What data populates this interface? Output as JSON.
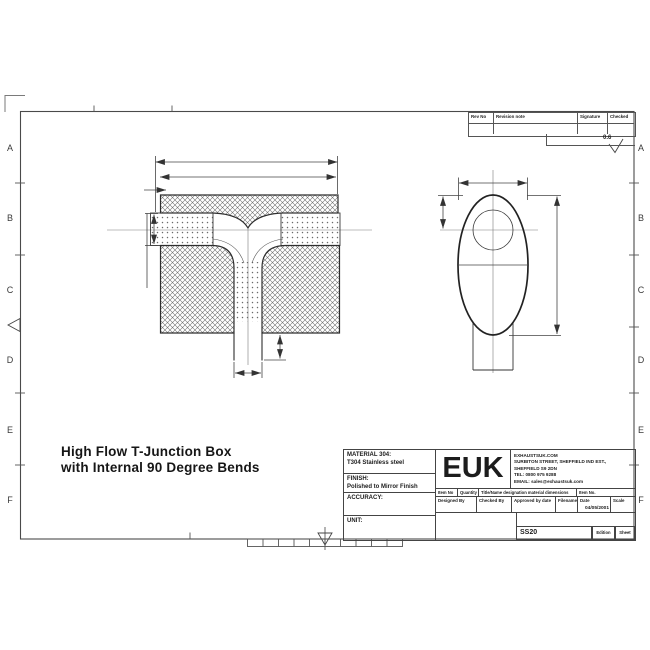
{
  "sheet": {
    "title_line1": "High Flow T-Junction Box",
    "title_line2": "with Internal 90 Degree Bends",
    "zone_letters": [
      "A",
      "B",
      "C",
      "D",
      "E",
      "F"
    ],
    "surface_finish_value": "0.6"
  },
  "revision_table": {
    "headers": [
      "Rev No",
      "Revision note",
      "Signature",
      "Checked"
    ]
  },
  "title_block": {
    "material_label": "MATERIAL 304:",
    "material_value": "T304 Stainless steel",
    "finish_label": "FINISH:",
    "finish_value": "Polished to Mirror Finish",
    "accuracy_label": "ACCURACY:",
    "unit_label": "UNIT:",
    "logo": "EUK",
    "company": {
      "line1": "EXHAUSTSUK.COM",
      "line2": "SURBITON STREET, SHEFFIELD IND EST.,",
      "line3": "SHEFFIELD S9 2DN",
      "line4": "TEL: 0800 975 9288",
      "line5": "EMAIL: sales@exhaustsuk.com"
    },
    "row1": {
      "item_no": "Item No",
      "quantity": "Quantity",
      "title_name": "Title/Name designation material dimensions",
      "item_no2": "Item No."
    },
    "row2": {
      "designed_by": "Designed By",
      "checked_by": "Checked By",
      "approved_by": "Approved by date",
      "filename": "Filename",
      "date": "Date",
      "scale": "Scale"
    },
    "date_value": "04/05/2001",
    "drawing_number": "SS20",
    "edition_label": "Edition",
    "sheet_label": "Sheet"
  },
  "colors": {
    "line": "#3a3a3a",
    "heavy_line": "#222222",
    "background": "#ffffff"
  }
}
